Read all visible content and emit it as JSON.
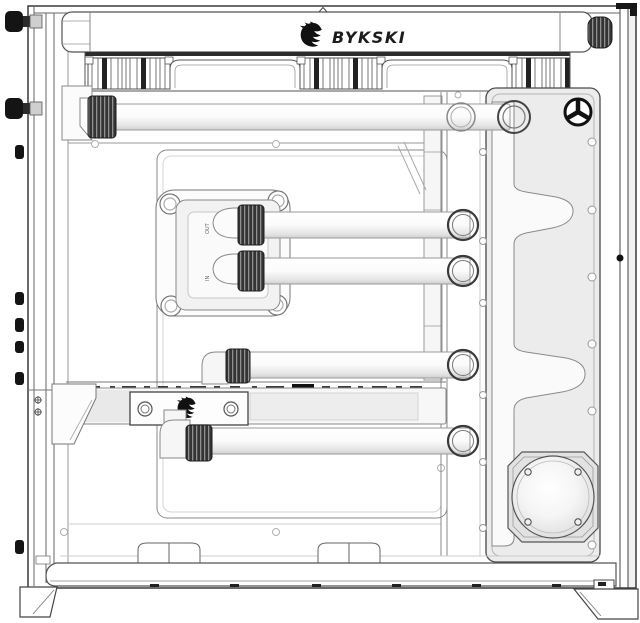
{
  "brand": {
    "name": "BYKSKI",
    "logo_icon": "bykski-dragon-icon"
  },
  "radiator": {
    "brand_text": "BYKSKI"
  },
  "cpu_block": {
    "port_label_top": "OUT",
    "port_label_bottom": "IN"
  },
  "components": [
    "case-frame",
    "radiator",
    "fan-row",
    "cpu-water-block",
    "gpu-water-block",
    "distro-plate-reservoir",
    "pump",
    "hard-tube",
    "compression-fitting",
    "bulkhead-ring",
    "fill-port-plug",
    "thumbscrew",
    "case-foot",
    "cable-cover-hump"
  ],
  "colors": {
    "background": "#ffffff",
    "line_dark": "#444444",
    "line_light": "#999999",
    "plate_fill": "#ececec",
    "channel_fill": "#fafafa",
    "knurl_fill": "#343434",
    "tube_shadow": "#cfcfcf",
    "logo_color": "#111111"
  }
}
